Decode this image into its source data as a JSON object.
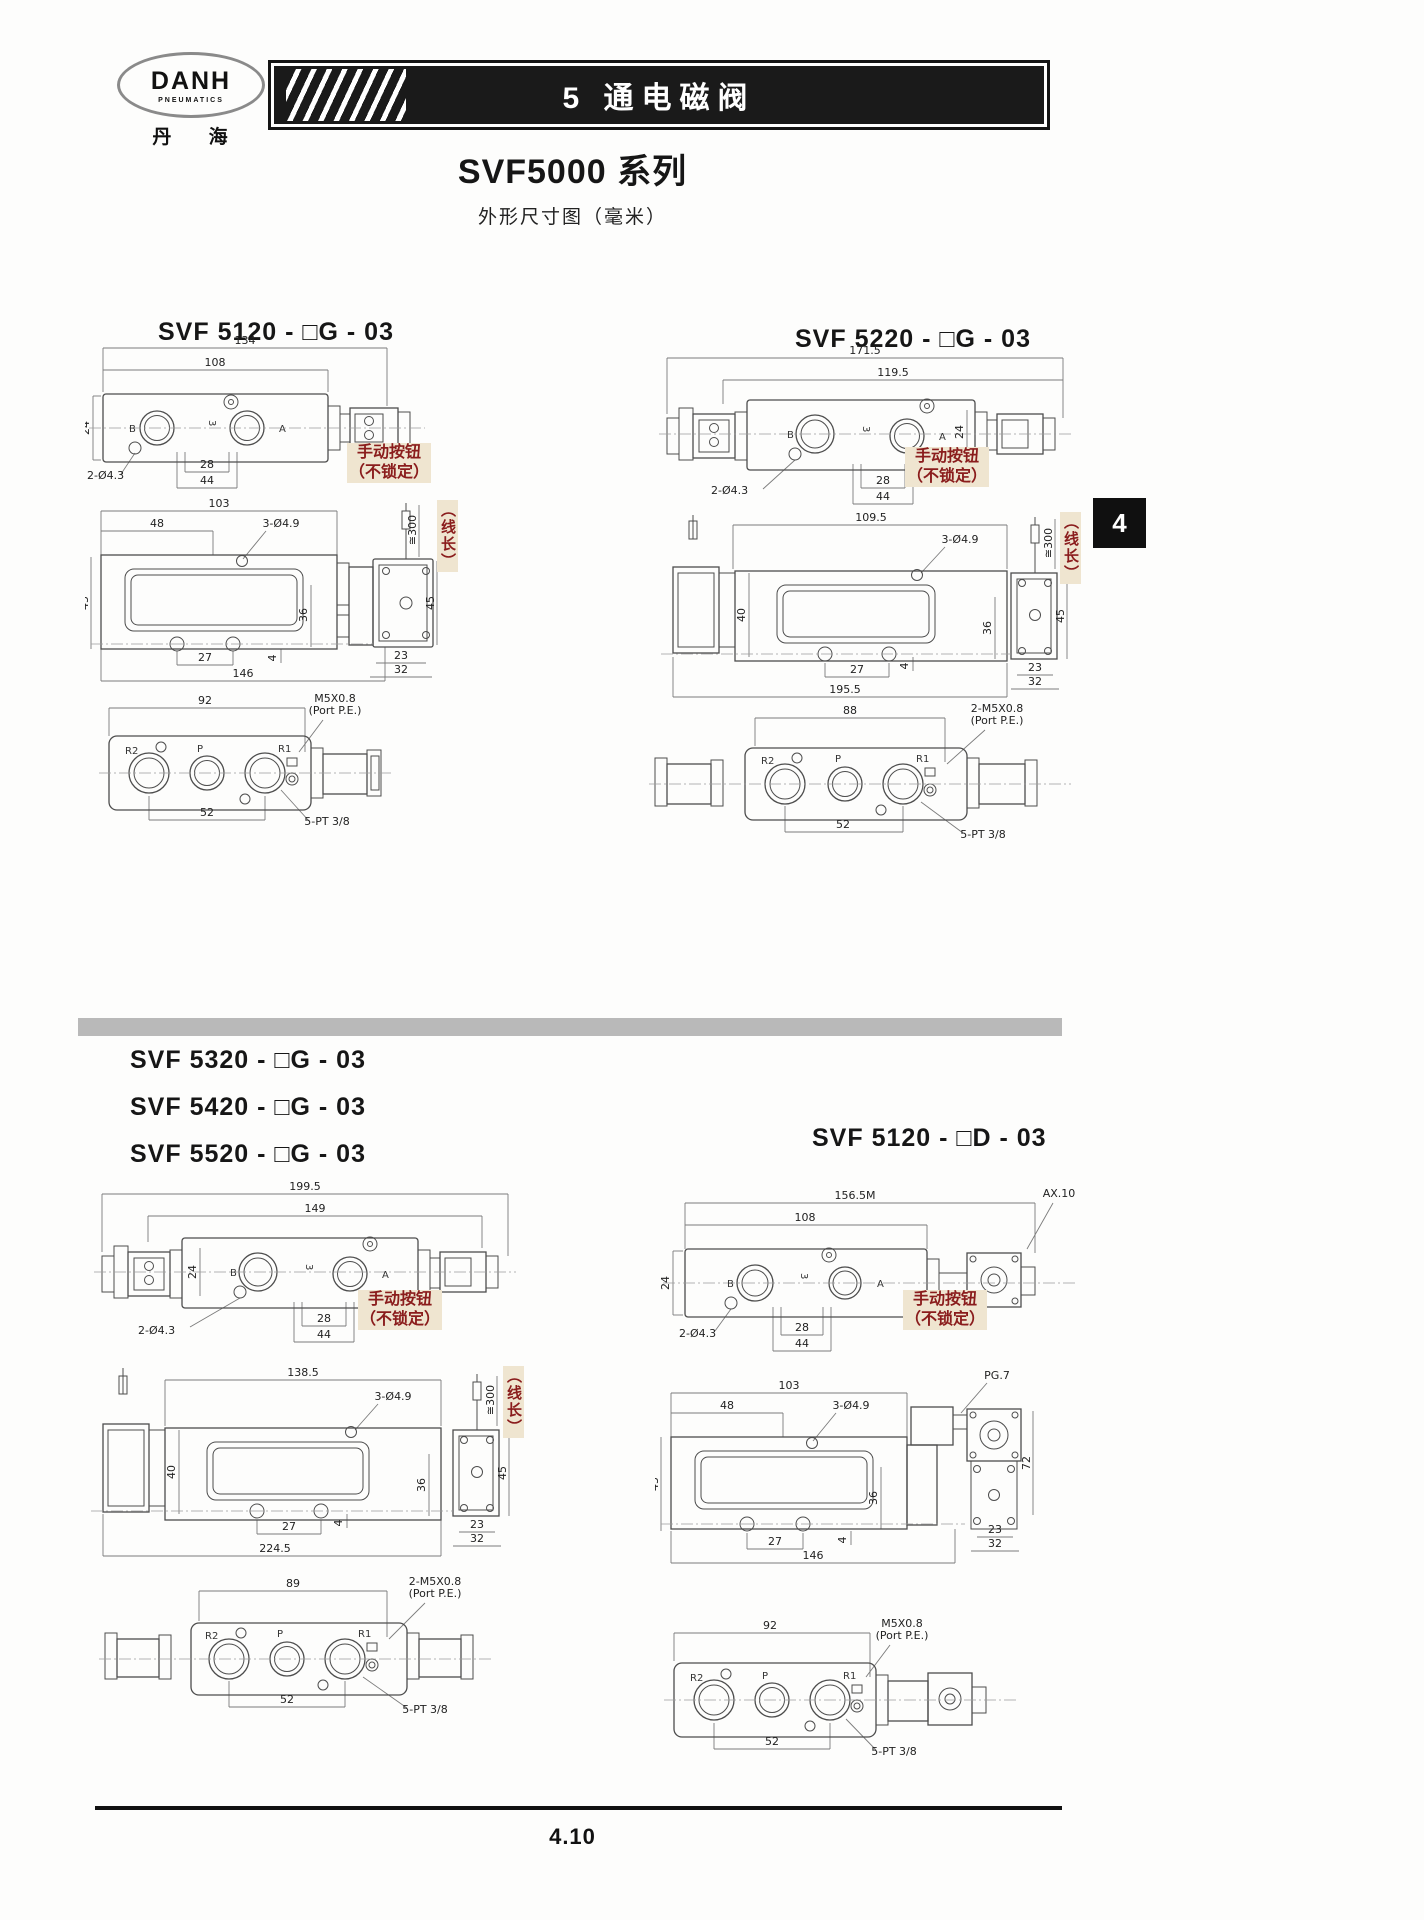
{
  "header": {
    "logo": {
      "name": "DANH",
      "sub": "PNEUMATICS",
      "cn": "丹 海"
    },
    "banner": "5 通电磁阀"
  },
  "page_title": "SVF5000 系列",
  "page_subtitle": "外形尺寸图（毫米）",
  "side_tab": "4",
  "footer_page": "4.10",
  "notes": {
    "manual_btn_line1": "手动按钮",
    "manual_btn_line2": "（不锁定）",
    "wire_len": "（线长）",
    "wire_len_dim": "≅300"
  },
  "figures": {
    "f1": {
      "title": "SVF 5120 - □G - 03",
      "top": {
        "total": "134",
        "body": "108",
        "h": "24",
        "b": "B",
        "p3": "3",
        "a": "A",
        "holes": "2-Ø4.3",
        "d28": "28",
        "d44": "44"
      },
      "front": {
        "d103": "103",
        "d48": "48",
        "holes": "3-Ø4.9",
        "d45": "45",
        "d36": "36",
        "d27": "27",
        "d4": "4",
        "total": "146",
        "sv23": "23",
        "sv32": "32",
        "sv45": "45"
      },
      "bottom": {
        "d92": "92",
        "thread": "M5X0.8",
        "thread2": "(Port P.E.)",
        "r2": "R2",
        "p": "P",
        "r1": "R1",
        "d52": "52",
        "pt": "5-PT 3/8"
      }
    },
    "f2": {
      "title": "SVF 5220 - □G - 03",
      "top": {
        "total": "171.5",
        "body": "119.5",
        "h": "24",
        "b": "B",
        "p3": "3",
        "a": "A",
        "holes": "2-Ø4.3",
        "d28": "28",
        "d44": "44"
      },
      "front": {
        "d109": "109.5",
        "holes": "3-Ø4.9",
        "d40": "40",
        "d36": "36",
        "d27": "27",
        "d4": "4",
        "total": "195.5",
        "sv23": "23",
        "sv32": "32",
        "sv45": "45"
      },
      "bottom": {
        "d88": "88",
        "thread": "2-M5X0.8",
        "thread2": "(Port P.E.)",
        "r2": "R2",
        "p": "P",
        "r1": "R1",
        "d52": "52",
        "pt": "5-PT 3/8"
      }
    },
    "f3": {
      "titles": [
        "SVF 5320 - □G - 03",
        "SVF 5420 - □G - 03",
        "SVF 5520 - □G - 03"
      ],
      "top": {
        "total": "199.5",
        "body": "149",
        "h": "24",
        "b": "B",
        "p3": "3",
        "a": "A",
        "holes": "2-Ø4.3",
        "d28": "28",
        "d44": "44"
      },
      "front": {
        "d138": "138.5",
        "holes": "3-Ø4.9",
        "d40": "40",
        "d36": "36",
        "d27": "27",
        "d4": "4",
        "total": "224.5",
        "sv23": "23",
        "sv32": "32",
        "sv45": "45"
      },
      "bottom": {
        "d89": "89",
        "thread": "2-M5X0.8",
        "thread2": "(Port P.E.)",
        "r2": "R2",
        "p": "P",
        "r1": "R1",
        "d52": "52",
        "pt": "5-PT 3/8"
      }
    },
    "f4": {
      "title": "SVF 5120 - □D - 03",
      "top": {
        "total": "156.5M",
        "ax": "AX.10",
        "body": "108",
        "h": "24",
        "b": "B",
        "p3": "3",
        "a": "A",
        "holes": "2-Ø4.3",
        "d28": "28",
        "d44": "44"
      },
      "front": {
        "pg": "PG.7",
        "d103": "103",
        "d48": "48",
        "holes": "3-Ø4.9",
        "d45": "45",
        "d36": "36",
        "d27": "27",
        "d4": "4",
        "total": "146",
        "sv72": "72",
        "sv23": "23",
        "sv32": "32"
      },
      "bottom": {
        "d92": "92",
        "thread": "M5X0.8",
        "thread2": "(Port P.E.)",
        "r2": "R2",
        "p": "P",
        "r1": "R1",
        "d52": "52",
        "pt": "5-PT 3/8"
      }
    }
  }
}
